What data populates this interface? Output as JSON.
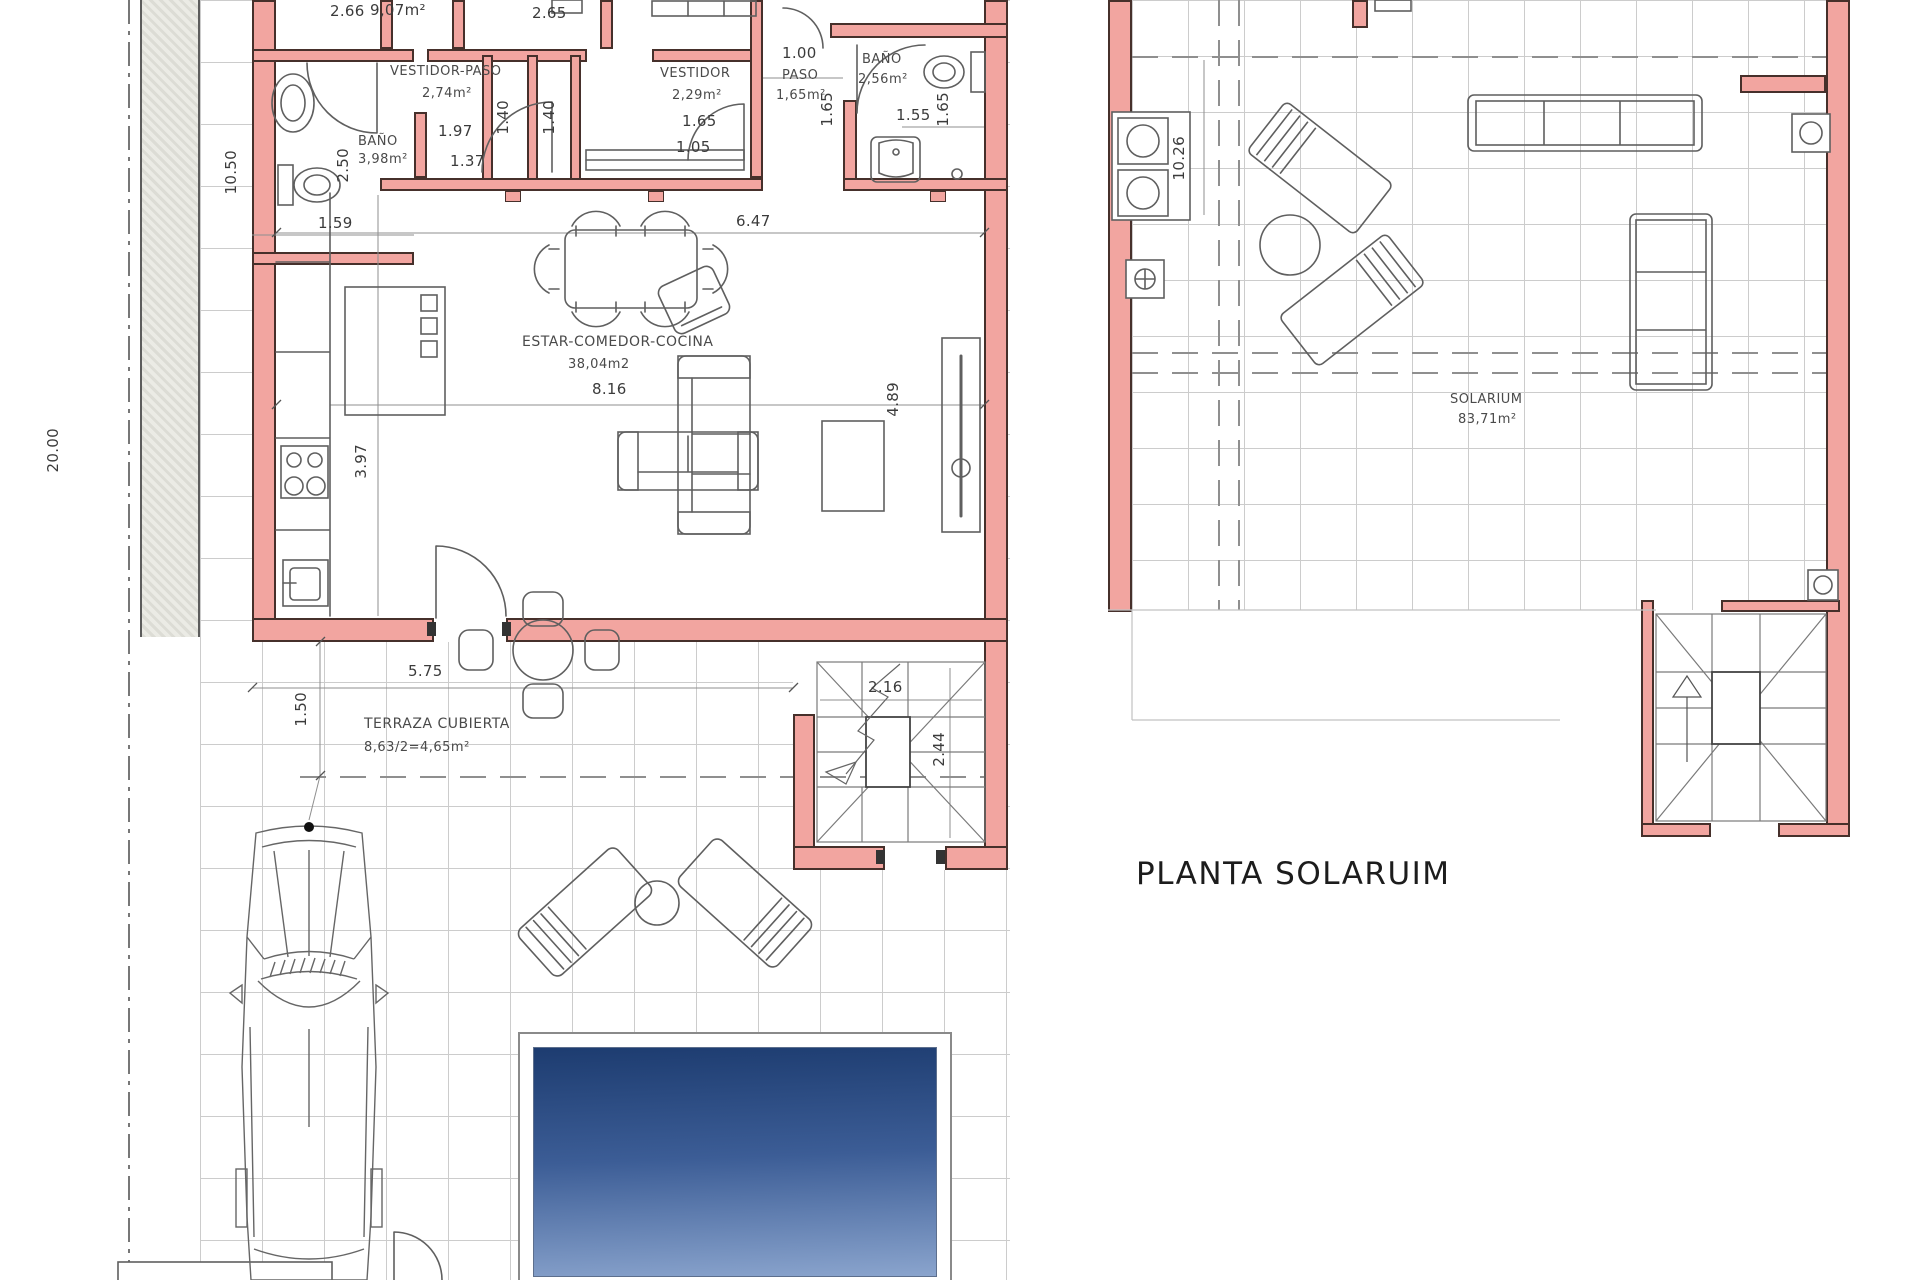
{
  "plan_left": {
    "rooms": {
      "bano1": {
        "name": "BAÑO",
        "area": "3,98m²"
      },
      "vestidor_paso": {
        "name": "VESTIDOR-PASO",
        "area": "2,74m²"
      },
      "vestidor": {
        "name": "VESTIDOR",
        "area": "2,29m²"
      },
      "paso": {
        "name": "PASO",
        "area": "1,65m²"
      },
      "bano2": {
        "name": "BAÑO",
        "area": "2,56m²"
      },
      "living": {
        "name": "ESTAR-COMEDOR-COCINA",
        "area": "38,04m2"
      },
      "terraza": {
        "name": "TERRAZA CUBIERTA",
        "area": "8,63/2=4,65m²"
      }
    },
    "dims": {
      "bedroom1_w": "2.66",
      "bedroom1_area": "9,07m²",
      "bedroom2_w": "2.65",
      "paso_top_w": "1.00",
      "plot_h": "20.00",
      "left_h": "10.50",
      "bano1_h": "2.50",
      "bano1_w": "1.59",
      "vestidorpaso_w1": "1.97",
      "vestidorpaso_w2": "1.37",
      "pasillo1_w": "1.40",
      "pasillo2_w": "1.40",
      "vestidor_w1": "1.65",
      "vestidor_w2": "1.05",
      "paso_h": "1.65",
      "bano2_w": "1.55",
      "bano2_h": "1.65",
      "living_top_w": "6.47",
      "living_w": "8.16",
      "living_h": "4.89",
      "kitchen_h": "3.97",
      "terraza_w": "5.75",
      "terraza_h": "1.50",
      "stairs_w": "2.16",
      "stairs_h": "2.44"
    }
  },
  "plan_right": {
    "title": "PLANTA SOLARUIM",
    "room": {
      "name": "SOLARIUM",
      "area": "83,71m²"
    },
    "dims": {
      "left_h": "10.26"
    }
  },
  "colors": {
    "wall_fill": "#F2A5A0",
    "wall_edge": "#46302B",
    "grid": "#cccccc",
    "strip": "#e4e4df",
    "pool_dark": "#1d3c70",
    "pool_light": "#8aa4cd"
  }
}
